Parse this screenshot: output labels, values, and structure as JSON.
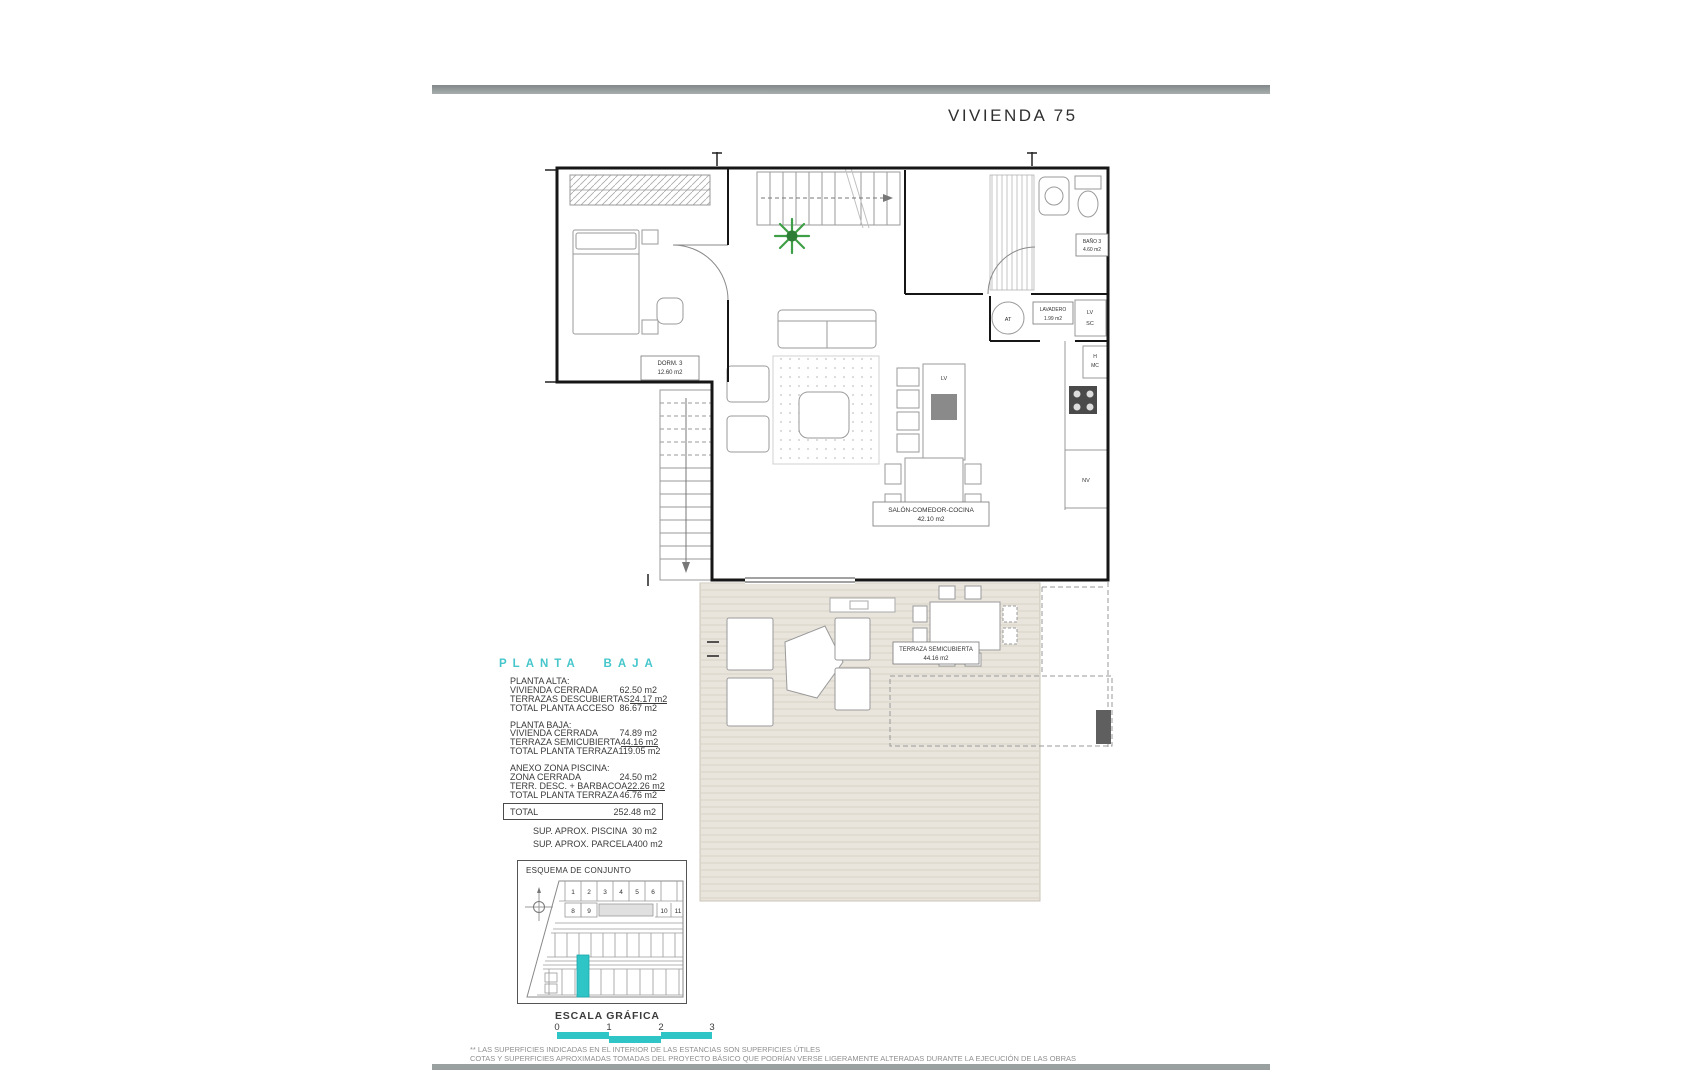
{
  "title": "VIVIENDA 75",
  "plan": {
    "rooms": {
      "dorm3": {
        "name": "DORM. 3",
        "area": "12.60 m2"
      },
      "bano3": {
        "name": "BAÑO 3",
        "area": "4.60 m2"
      },
      "lavadero": {
        "name": "LAVADERO",
        "area": "1.99 m2"
      },
      "salon": {
        "name": "SALÓN-COMEDOR-COCINA",
        "area": "42.10 m2"
      },
      "terraza": {
        "name": "TERRAZA SEMICUBIERTA",
        "area": "44.16 m2"
      }
    },
    "tags": {
      "at": "AT",
      "lv": "LV",
      "sc": "SC",
      "h": "H",
      "mc": "MC",
      "lv_island": "LV",
      "nv": "NV"
    }
  },
  "summary": {
    "heading": "PLANTA BAJA",
    "sections": [
      {
        "title": "PLANTA ALTA:",
        "rows": [
          [
            "VIVIENDA CERRADA",
            "62.50 m2"
          ],
          [
            "TERRAZAS DESCUBIERTAS",
            "24.17 m2"
          ],
          [
            "TOTAL PLANTA ACCESO",
            "86.67 m2"
          ]
        ]
      },
      {
        "title": "PLANTA BAJA:",
        "rows": [
          [
            "VIVIENDA CERRADA",
            "74.89 m2"
          ],
          [
            "TERRAZA SEMICUBIERTA",
            "44.16 m2"
          ],
          [
            "TOTAL PLANTA TERRAZA",
            "119.05 m2"
          ]
        ]
      },
      {
        "title": "ANEXO ZONA PISCINA:",
        "rows": [
          [
            "ZONA CERRADA",
            "24.50 m2"
          ],
          [
            "TERR. DESC. + BARBACOA",
            "22.26 m2"
          ],
          [
            "TOTAL PLANTA TERRAZA",
            "46.76 m2"
          ]
        ]
      }
    ],
    "total": {
      "label": "TOTAL",
      "value": "252.48 m2"
    },
    "extras": [
      [
        "SUP.  APROX. PISCINA",
        "30 m2"
      ],
      [
        "SUP.  APROX. PARCELA",
        "400 m2"
      ]
    ]
  },
  "esquema": {
    "title": "ESQUEMA DE CONJUNTO",
    "plot_numbers": [
      "1",
      "2",
      "3",
      "4",
      "5",
      "6",
      "8",
      "9",
      "10",
      "11"
    ]
  },
  "scale": {
    "title": "ESCALA GRÁFICA",
    "ticks": [
      "0",
      "1",
      "2",
      "3"
    ]
  },
  "footnotes": [
    "** LAS SUPERFICIES INDICADAS EN EL INTERIOR DE LAS ESTANCIAS SON SUPERFICIES ÚTILES",
    "COTAS Y SUPERFICIES APROXIMADAS TOMADAS DEL PROYECTO BÁSICO QUE PODRÍAN VERSE LIGERAMENTE ALTERADAS DURANTE LA EJECUCIÓN DE LAS OBRAS"
  ],
  "colors": {
    "accent_cyan": "#2fc4c6",
    "heading_cyan": "#45c6cb",
    "terrace_beige": "#e9e5dd",
    "wall_black": "#161616",
    "bar_gray": "#9aa0a0",
    "note_gray": "#8f8f8f"
  }
}
